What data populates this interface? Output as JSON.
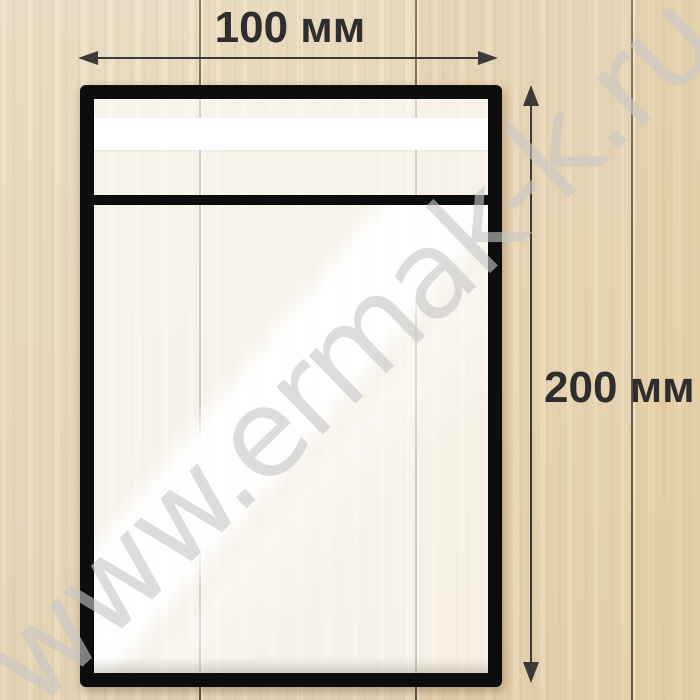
{
  "annotations": {
    "width_label": "100 мм",
    "height_label": "200 мм"
  },
  "watermark_text": "www.ermak-k.ru",
  "colors": {
    "bag_border": "#0d0d0d",
    "tape_strip": "#ffffff",
    "dimension_ink": "#2e2e2e",
    "wood_light": "#ece0c8",
    "wood_dark": "#e6d1a8",
    "watermark_gray": "#c6c6c6"
  }
}
